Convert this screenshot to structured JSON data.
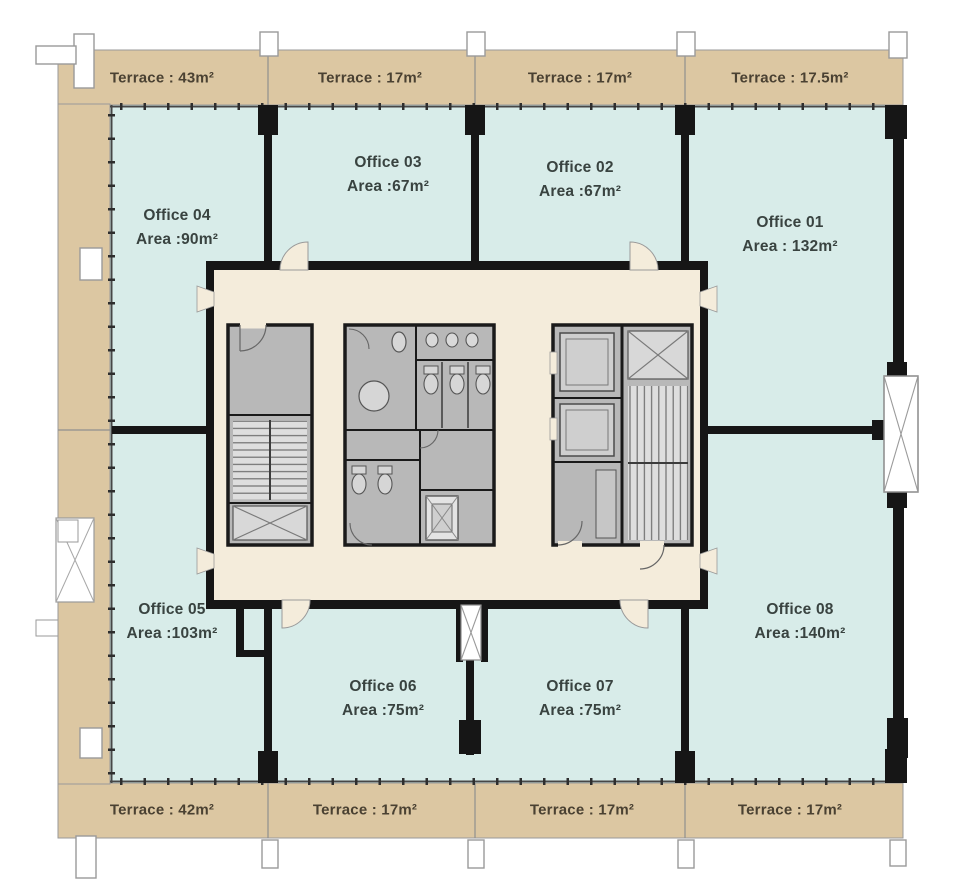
{
  "colors": {
    "terrace_fill": "#dcc7a2",
    "office_fill": "#d8ece9",
    "corridor_fill": "#f4ecdb",
    "wall": "#161616",
    "service_room_fill": "#b8b8b8",
    "office_text": "#394340",
    "terrace_text": "#4a4132"
  },
  "offices": [
    {
      "name": "Office 01",
      "area": "Area : 132m²"
    },
    {
      "name": "Office 02",
      "area": "Area :67m²"
    },
    {
      "name": "Office 03",
      "area": "Area :67m²"
    },
    {
      "name": "Office 04",
      "area": "Area :90m²"
    },
    {
      "name": "Office 05",
      "area": "Area :103m²"
    },
    {
      "name": "Office 06",
      "area": "Area :75m²"
    },
    {
      "name": "Office 07",
      "area": "Area :75m²"
    },
    {
      "name": "Office 08",
      "area": "Area :140m²"
    }
  ],
  "terraces_top": [
    {
      "label": "Terrace : 43m²"
    },
    {
      "label": "Terrace : 17m²"
    },
    {
      "label": "Terrace : 17m²"
    },
    {
      "label": "Terrace : 17.5m²"
    }
  ],
  "terraces_bottom": [
    {
      "label": "Terrace : 42m²"
    },
    {
      "label": "Terrace : 17m²"
    },
    {
      "label": "Terrace : 17m²"
    },
    {
      "label": "Terrace : 17m²"
    }
  ]
}
